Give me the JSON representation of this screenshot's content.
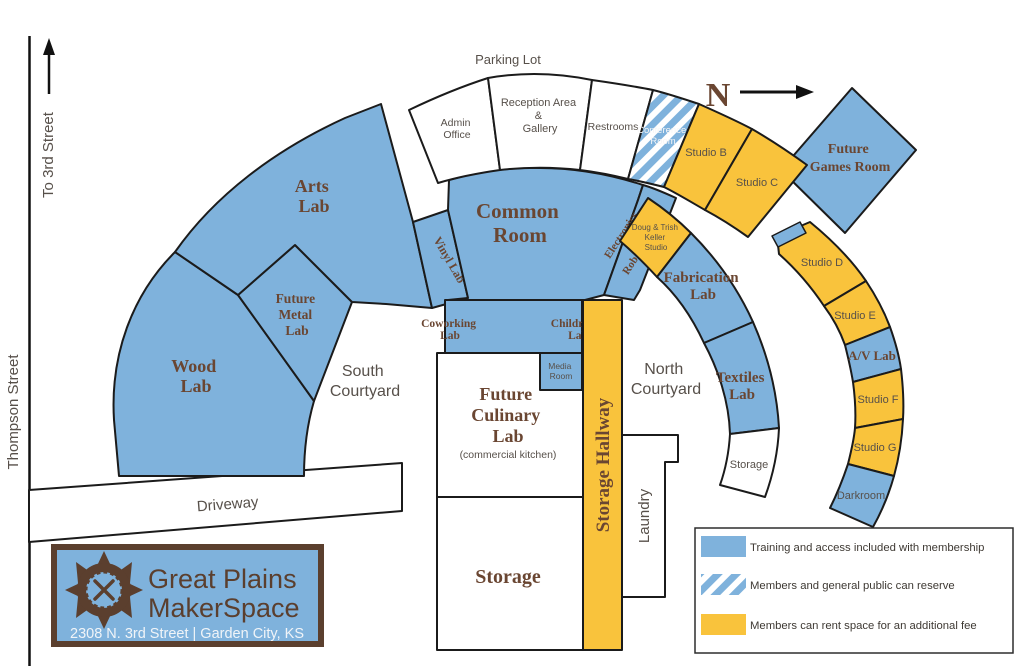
{
  "map": {
    "compass": {
      "n": "N"
    },
    "streets": {
      "parking_lot": "Parking Lot",
      "to_3rd_street": "To 3rd Street",
      "thompson_street": "Thompson Street",
      "driveway": "Driveway"
    },
    "rooms": {
      "admin_office": {
        "line1": "Admin",
        "line2": "Office"
      },
      "reception": {
        "line1": "Reception Area",
        "line2": "&",
        "line3": "Gallery"
      },
      "restrooms": {
        "label": "Restrooms"
      },
      "conference": {
        "line1": "Conference",
        "line2": "Room"
      },
      "studio_b": {
        "label": "Studio B"
      },
      "studio_c": {
        "label": "Studio C"
      },
      "future_games": {
        "line1": "Future",
        "line2": "Games Room"
      },
      "arts_lab": {
        "line1": "Arts",
        "line2": "Lab"
      },
      "common_room": {
        "line1": "Common",
        "line2": "Room"
      },
      "vinyl_lab": {
        "label": "Vinyl Lab"
      },
      "electronics": {
        "line1": "Electronics",
        "line2": "&",
        "line3": "Robotics Lab"
      },
      "doug_trish": {
        "line1": "Doug & Trish",
        "line2": "Keller",
        "line3": "Studio"
      },
      "fabrication": {
        "line1": "Fabrication",
        "line2": "Lab"
      },
      "textiles": {
        "line1": "Textiles",
        "line2": "Lab"
      },
      "storage_arc": {
        "label": "Storage"
      },
      "studio_d": {
        "label": "Studio D"
      },
      "studio_e": {
        "label": "Studio E"
      },
      "av_lab": {
        "label": "A/V Lab"
      },
      "studio_f": {
        "label": "Studio F"
      },
      "studio_g": {
        "label": "Studio G"
      },
      "darkroom": {
        "label": "Darkroom"
      },
      "wood_lab": {
        "line1": "Wood",
        "line2": "Lab"
      },
      "metal_lab": {
        "line1": "Future",
        "line2": "Metal",
        "line3": "Lab"
      },
      "south_courtyard": {
        "line1": "South",
        "line2": "Courtyard"
      },
      "north_courtyard": {
        "line1": "North",
        "line2": "Courtyard"
      },
      "coworking": {
        "line1": "Coworking",
        "line2": "Lab"
      },
      "childrens": {
        "line1": "Children's",
        "line2": "Lab"
      },
      "media_room": {
        "line1": "Media",
        "line2": "Room"
      },
      "culinary": {
        "line1": "Future",
        "line2": "Culinary",
        "line3": "Lab",
        "note": "(commercial kitchen)"
      },
      "storage_hallway": {
        "label": "Storage Hallway"
      },
      "laundry": {
        "label": "Laundry"
      },
      "storage_main": {
        "label": "Storage"
      }
    },
    "legend": {
      "items": [
        {
          "style": "solid-blue",
          "label": "Training and access included with membership"
        },
        {
          "style": "striped-blue",
          "label": "Members and general public can reserve"
        },
        {
          "style": "solid-yellow",
          "label": "Members can rent space for an additional fee"
        }
      ]
    },
    "logo": {
      "name_line1": "Great Plains",
      "name_line2": "MakerSpace",
      "address": "2308 N. 3rd Street | Garden City, KS"
    },
    "colors": {
      "membership_blue": "#7FB2DC",
      "rental_yellow": "#F9C33C",
      "label_brown": "#6A4632",
      "logo_brown": "#5B3F2E"
    }
  }
}
